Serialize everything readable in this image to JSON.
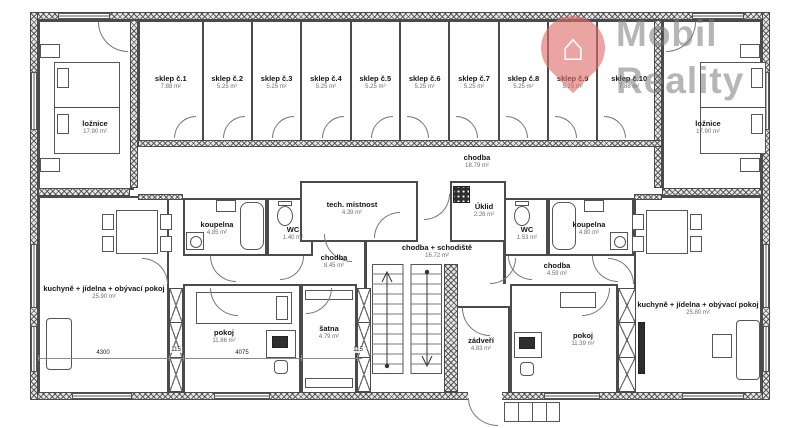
{
  "brand": {
    "line1": "Mobil",
    "line2": "Reality",
    "house_icon": "⌂",
    "pin_color": "#dd6e69",
    "text_color": "#7a7a7a"
  },
  "rooms": {
    "loznice_left": {
      "name": "ložnice",
      "area": "17.90 m²"
    },
    "loznice_right": {
      "name": "ložnice",
      "area": "17.90 m²"
    },
    "sklep1": {
      "name": "sklep č.1",
      "area": "7.88 m²"
    },
    "sklep2": {
      "name": "sklep č.2",
      "area": "5.25 m²"
    },
    "sklep3": {
      "name": "sklep č.3",
      "area": "5.25 m²"
    },
    "sklep4": {
      "name": "sklep č.4",
      "area": "5.25 m²"
    },
    "sklep5": {
      "name": "sklep č.5",
      "area": "5.25 m²"
    },
    "sklep6": {
      "name": "sklep č.6",
      "area": "5.25 m²"
    },
    "sklep7": {
      "name": "sklep č.7",
      "area": "5.25 m²"
    },
    "sklep8": {
      "name": "sklep č.8",
      "area": "5.25 m²"
    },
    "sklep9": {
      "name": "sklep č.9",
      "area": "5.25 m²"
    },
    "sklep10": {
      "name": "sklep č.10",
      "area": "7.88 m²"
    },
    "chodba_top": {
      "name": "chodba",
      "area": "18.79 m²"
    },
    "tech_mistnost": {
      "name": "tech. místnost",
      "area": "4.39 m²"
    },
    "uklid": {
      "name": "Úklid",
      "area": "2.26 m²"
    },
    "koupelna_left": {
      "name": "koupelna",
      "area": "4.85 m²"
    },
    "wc_left": {
      "name": "WC",
      "area": "1.40 m²"
    },
    "chodba_left": {
      "name": "chodba",
      "area": "8.45 m²"
    },
    "kuchyne_left": {
      "name": "kuchyně + jídelna + obývací pokoj",
      "area": "25.90 m²"
    },
    "pokoj_left": {
      "name": "pokoj",
      "area": "11.86 m²"
    },
    "satna": {
      "name": "šatna",
      "area": "4.79 m²"
    },
    "schodiste": {
      "name": "chodba + schodiště",
      "area": "16.72 m²"
    },
    "zadveri": {
      "name": "zádveří",
      "area": "4.83 m²"
    },
    "wc_right": {
      "name": "WC",
      "area": "1.53 m²"
    },
    "koupelna_right": {
      "name": "koupelna",
      "area": "4.80 m²"
    },
    "chodba_right": {
      "name": "chodba",
      "area": "4.59 m²"
    },
    "pokoj_right": {
      "name": "pokoj",
      "area": "11.39 m²"
    },
    "kuchyne_right": {
      "name": "kuchyně + jídelna + obývací pokoj",
      "area": "25.80 m²"
    }
  },
  "dimensions": {
    "kuchyne_width": "4300",
    "wall1": "115",
    "pokoj_width": "4075",
    "wall2": "115"
  }
}
